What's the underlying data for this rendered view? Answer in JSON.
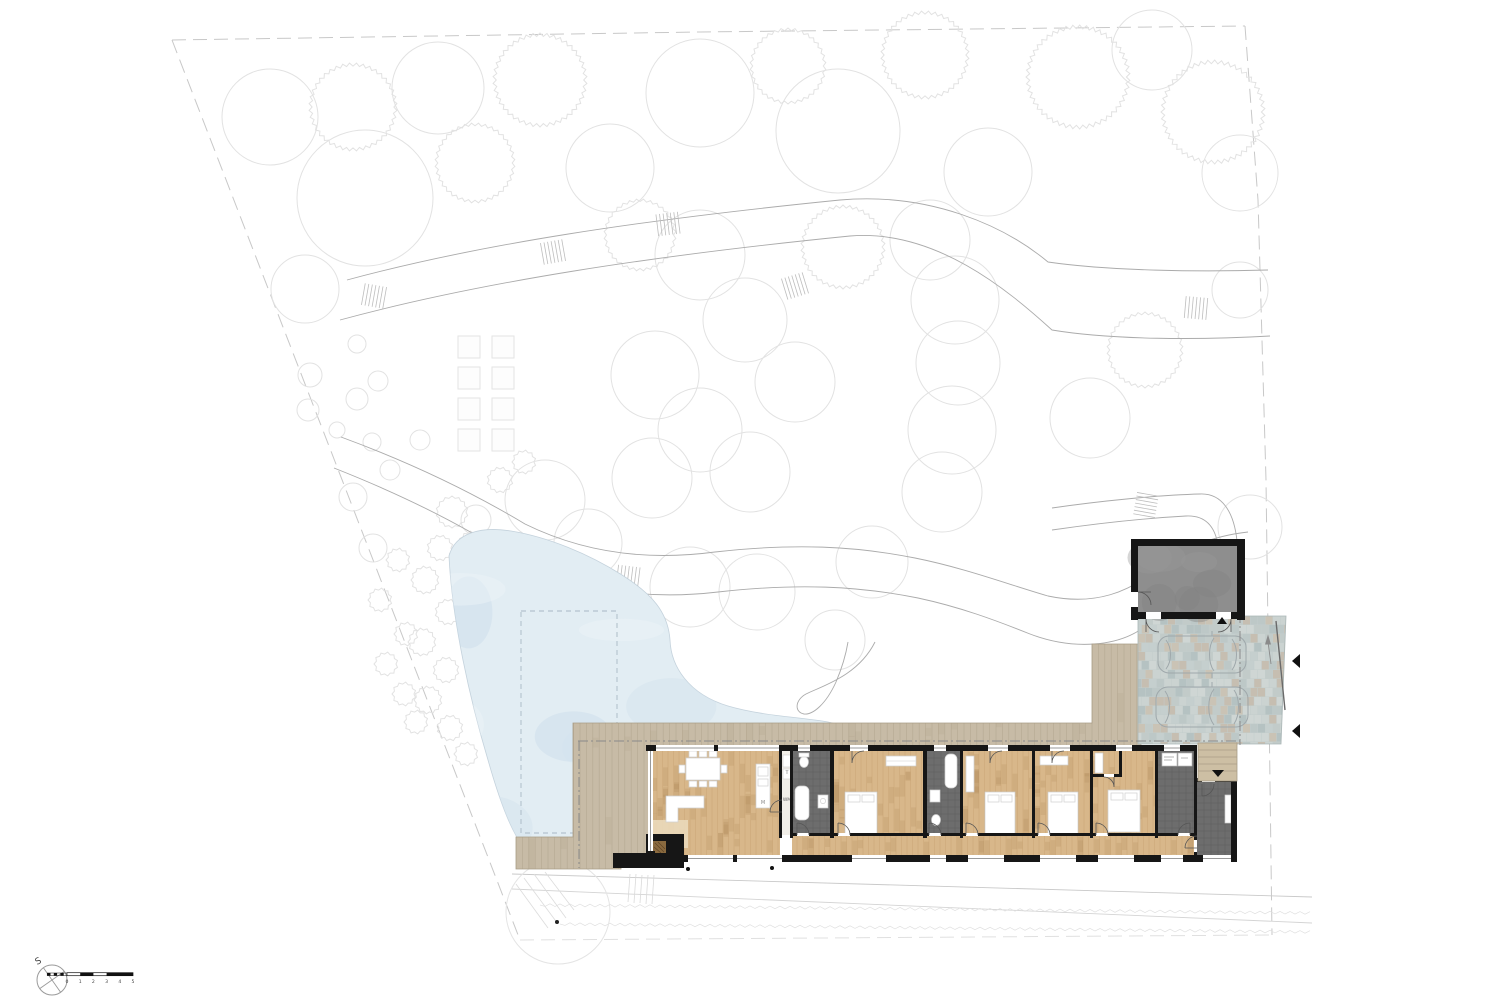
{
  "plan": {
    "compass_label": "S",
    "scale_bar": {
      "labels": [
        "0",
        "1",
        "2",
        "3",
        "4",
        "5"
      ]
    },
    "room_labels": {
      "shaft": "T",
      "laundry": "WM",
      "kitchen_island": "M"
    },
    "colors": {
      "wood_floor": "#d8b78a",
      "deck": "#c7bba6",
      "wet_room_floor": "#6d6d6d",
      "garage_floor": "#8e8e8e",
      "paving": "#c3cdcc",
      "pond": "#e2edf3",
      "wall": "#161616",
      "tree_outline": "#e2e2e2",
      "path_line": "#ababab",
      "steps": "#cdbfa4"
    }
  }
}
